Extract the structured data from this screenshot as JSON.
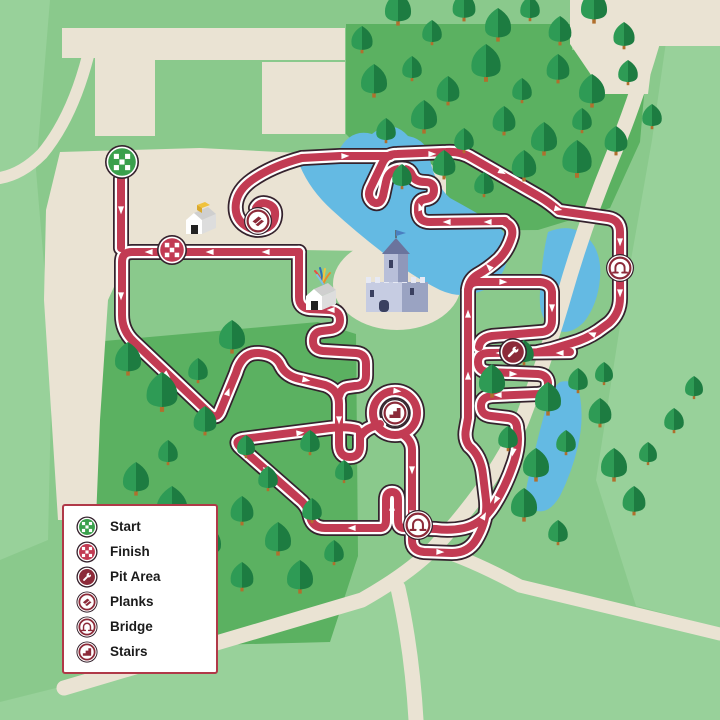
{
  "legend": {
    "items": [
      {
        "id": "start",
        "label": "Start"
      },
      {
        "id": "finish",
        "label": "Finish"
      },
      {
        "id": "pit",
        "label": "Pit Area"
      },
      {
        "id": "planks",
        "label": "Planks"
      },
      {
        "id": "bridge",
        "label": "Bridge"
      },
      {
        "id": "stairs",
        "label": "Stairs"
      }
    ]
  },
  "map": {
    "colors": {
      "base": "#8AC98C",
      "light": "#98D19A",
      "forest": "#5BB161",
      "beige": "#EAE3D3",
      "water": "#64BAE3",
      "red": "#C23B53",
      "dark": "#35222D",
      "maroon": "#8C2A39",
      "green": "#3AA04C",
      "treeL": "#2E9B55",
      "treeD": "#1D7C41",
      "trunk": "#B06F2D",
      "white": "#FFFFFF",
      "legendBorder": "#B03948"
    },
    "light_patches": [
      "M0,0 L50,0 L36,170 L52,360 L48,540 L0,560 Z",
      "M64,686 L360,602 L432,552 L520,586 L720,636 L720,720 L0,720 L0,702 Z",
      "M672,0 L720,0 L720,628 L636,606 L596,480 L624,300 L652,140 Z"
    ],
    "forest_fields": [
      "M346,24 L572,24 L572,50 L648,50 L640,142 L610,208 L538,230 L440,231 L346,134 Z",
      "M93,342 L318,322 L356,334 L358,556 L330,642 L96,648 Z"
    ],
    "plazas": [
      "M62,28 L345,28 L345,60 L155,60 L155,70 L95,70 L95,58 L62,58 Z",
      "M95,70 L155,70 L155,136 L95,136 Z",
      "M262,62 L345,62 L345,134 L262,134 Z",
      "M570,0 L720,0 L720,46 L654,46 L648,94 L604,94 L570,44 Z",
      "M60,152 L200,148 L340,155 L430,163 L446,178 L446,240 L436,252 L300,250 L255,246 L130,252 L108,300 L100,420 L96,520 L58,520 L44,300 L46,210 Z"
    ],
    "castle_plaza": {
      "cx": 397,
      "cy": 284,
      "rx": 64,
      "ry": 46
    },
    "water": [
      "M300,166 Q318,150 338,152 Q350,128 372,134 Q392,118 408,136 Q428,140 430,160 Q436,186 450,198 Q472,210 492,222 Q510,232 508,254 Q506,278 484,290 Q462,300 440,290 Q408,274 382,252 Q356,232 332,210 Q310,190 300,166 Z",
      "M548,232 Q572,222 588,238 Q602,252 600,278 Q598,304 584,322 Q568,338 552,328 Q538,318 540,292 Q542,256 548,232 Z",
      "M560,382 Q576,378 580,396 Q584,420 578,446 Q572,472 560,496 Q548,516 534,510 Q522,504 528,480 Q538,436 546,408 Q552,388 560,382 Z"
    ],
    "roads": [
      {
        "d": "M664,0 Q642,86 612,158 Q584,226 564,296 Q548,352 522,420 Q498,478 434,548 Q408,574 362,600 L64,688",
        "w": 15
      },
      {
        "d": "M434,548 Q472,560 520,586 L720,634",
        "w": 13
      },
      {
        "d": "M398,588 Q412,650 416,720",
        "w": 15
      },
      {
        "d": "M88,56 Q72,118 42,154 Q22,174 0,178",
        "w": 12
      }
    ],
    "course": {
      "subpaths": [
        "M121,179 L121,248",
        "M299,252 L132,252 Q122,252 122,262 L122,315 Q122,331 134,342 L209,413 Q216,420 220,412 L236,373 Q242,352 259,353 Q276,354 281,366 Q286,376 300,379 L325,385 Q339,390 339,404 L339,444 Q339,457 350,457 Q360,457 360,446 L360,432",
        "M299,252 L299,297 Q299,308 310,309 L330,310 Q340,311 340,320 Q340,329 330,330 L322,331 Q313,332 313,341 Q313,350 323,351 L356,353 Q366,354 366,364 L366,375 Q366,386 355,386 L348,387 Q341,388 339,396",
        "M360,437 Q364,430 372,427 L380,424",
        "M402,434 Q412,440 412,450 L412,540 Q412,551 424,552 L452,553 Q468,553 476,540 Q488,520 486,500 L483,475 Q481,456 469,446 Q464,439 466,429 L468,418 L468,292 Q468,282 478,282 L540,282 Q551,283 552,292 L552,320 Q552,331 542,332 L492,336 Q480,338 479,347",
        "M517,428 Q520,444 514,462 Q506,486 494,505 Q482,524 464,528 Q450,531 436,529 L404,528 Q398,528 398,520 L398,500 Q398,492 392,492 Q386,492 386,500 L386,520 Q386,528 380,528 L325,528 Q313,528 310,517 Q308,506 299,499 L241,448 Q233,441 243,439 L330,428 Q346,426 357,429",
        "M570,352 L489,353 Q478,353 478,362 Q478,371 488,372 L538,374 Q548,375 548,384 Q548,393 538,394 L492,396 Q481,397 481,406 Q481,415 491,416 L508,418 Q516,419 517,427",
        "M505,222 Q514,226 512,236 Q508,250 499,259 Q488,269 477,275 Q469,280 468,290",
        "M505,221 L430,222 Q419,222 418,212 L418,208 Q418,200 426,199 Q434,198 434,190 Q434,182 425,182 Q415,182 412,175 Q409,167 398,169 Q388,171 386,182 L383,196 Q380,206 373,202 Q367,197 370,189 L382,164 Q386,154 397,154 L446,152 Q461,151 472,158 L540,197 Q550,203 559,211 L608,218 Q620,220 620,232 L620,298 Q620,313 609,323 L598,331 Q586,339 572,343 L552,349 Q543,351 538,352",
        "M302,158 Q272,166 252,180 Q238,190 236,203 Q234,216 243,224 Q253,232 264,229 Q274,226 275,216 Q276,207 268,204 Q260,201 256,208",
        "M302,158 L340,156 L390,156"
      ],
      "loop_circle": {
        "cx": 395,
        "cy": 413,
        "r": 22
      }
    },
    "arrows": [
      [
        121,
        210,
        90
      ],
      [
        121,
        296,
        90
      ],
      [
        149,
        252,
        180
      ],
      [
        210,
        252,
        180
      ],
      [
        266,
        252,
        180
      ],
      [
        167,
        375,
        41
      ],
      [
        228,
        392,
        -70
      ],
      [
        306,
        380,
        11
      ],
      [
        331,
        310,
        180
      ],
      [
        339,
        420,
        90
      ],
      [
        397,
        391,
        6
      ],
      [
        412,
        470,
        90
      ],
      [
        412,
        514,
        90
      ],
      [
        440,
        552,
        2
      ],
      [
        484,
        516,
        -62
      ],
      [
        468,
        376,
        -90
      ],
      [
        468,
        314,
        -90
      ],
      [
        503,
        282,
        2
      ],
      [
        552,
        308,
        90
      ],
      [
        560,
        353,
        180
      ],
      [
        500,
        353,
        180
      ],
      [
        513,
        374,
        2
      ],
      [
        498,
        395,
        180
      ],
      [
        513,
        452,
        100
      ],
      [
        496,
        500,
        118
      ],
      [
        352,
        528,
        180
      ],
      [
        392,
        507,
        -90
      ],
      [
        310,
        512,
        205
      ],
      [
        266,
        470,
        222
      ],
      [
        300,
        433,
        -6
      ],
      [
        488,
        222,
        180
      ],
      [
        447,
        222,
        180
      ],
      [
        420,
        207,
        250
      ],
      [
        403,
        166,
        -35
      ],
      [
        432,
        154,
        0
      ],
      [
        345,
        156,
        -2
      ],
      [
        502,
        172,
        28
      ],
      [
        558,
        209,
        13
      ],
      [
        620,
        242,
        90
      ],
      [
        620,
        293,
        90
      ],
      [
        592,
        334,
        200
      ],
      [
        489,
        267,
        225
      ]
    ],
    "markers": [
      {
        "type": "start",
        "x": 122,
        "y": 162,
        "r": 17
      },
      {
        "type": "finish",
        "x": 172,
        "y": 250,
        "r": 15
      },
      {
        "type": "planks",
        "x": 258,
        "y": 221,
        "r": 14
      },
      {
        "type": "bridge",
        "x": 620,
        "y": 268,
        "r": 14
      },
      {
        "type": "pit",
        "x": 513,
        "y": 352,
        "r": 14
      },
      {
        "type": "stairs",
        "x": 395,
        "y": 413,
        "r": 14
      },
      {
        "type": "bridge",
        "x": 418,
        "y": 525,
        "r": 15
      }
    ],
    "buildings": [
      {
        "kind": "hut",
        "x": 203,
        "y": 222,
        "crate": true
      },
      {
        "kind": "hut",
        "x": 323,
        "y": 298,
        "streamers": true
      },
      {
        "kind": "castle",
        "x": 396,
        "y": 288
      }
    ],
    "trees": [
      [
        362,
        52,
        26
      ],
      [
        398,
        24,
        32
      ],
      [
        432,
        44,
        24
      ],
      [
        464,
        20,
        28
      ],
      [
        498,
        40,
        32
      ],
      [
        530,
        20,
        24
      ],
      [
        560,
        44,
        28
      ],
      [
        594,
        22,
        32
      ],
      [
        624,
        48,
        26
      ],
      [
        374,
        96,
        32
      ],
      [
        412,
        80,
        24
      ],
      [
        448,
        104,
        28
      ],
      [
        486,
        80,
        36
      ],
      [
        522,
        102,
        24
      ],
      [
        558,
        82,
        28
      ],
      [
        592,
        106,
        32
      ],
      [
        628,
        84,
        24
      ],
      [
        386,
        142,
        24
      ],
      [
        424,
        132,
        32
      ],
      [
        464,
        152,
        24
      ],
      [
        504,
        134,
        28
      ],
      [
        544,
        154,
        32
      ],
      [
        582,
        132,
        24
      ],
      [
        616,
        154,
        28
      ],
      [
        402,
        188,
        24
      ],
      [
        444,
        178,
        28
      ],
      [
        484,
        196,
        24
      ],
      [
        524,
        180,
        30
      ],
      [
        577,
        176,
        36
      ],
      [
        652,
        128,
        24
      ],
      [
        128,
        374,
        32
      ],
      [
        162,
        410,
        38
      ],
      [
        198,
        382,
        24
      ],
      [
        232,
        352,
        32
      ],
      [
        205,
        434,
        28
      ],
      [
        168,
        464,
        24
      ],
      [
        136,
        494,
        32
      ],
      [
        172,
        524,
        38
      ],
      [
        208,
        557,
        32
      ],
      [
        242,
        524,
        28
      ],
      [
        268,
        490,
        24
      ],
      [
        246,
        457,
        22
      ],
      [
        278,
        554,
        32
      ],
      [
        312,
        522,
        24
      ],
      [
        242,
        590,
        28
      ],
      [
        300,
        592,
        32
      ],
      [
        334,
        564,
        24
      ],
      [
        124,
        546,
        24
      ],
      [
        310,
        454,
        24
      ],
      [
        344,
        482,
        22
      ],
      [
        492,
        396,
        32
      ],
      [
        524,
        364,
        24
      ],
      [
        548,
        414,
        32
      ],
      [
        578,
        392,
        24
      ],
      [
        508,
        450,
        24
      ],
      [
        536,
        480,
        32
      ],
      [
        566,
        454,
        24
      ],
      [
        600,
        426,
        28
      ],
      [
        614,
        480,
        32
      ],
      [
        634,
        514,
        28
      ],
      [
        524,
        520,
        32
      ],
      [
        558,
        544,
        24
      ],
      [
        648,
        464,
        22
      ],
      [
        674,
        432,
        24
      ],
      [
        694,
        398,
        22
      ],
      [
        604,
        384,
        22
      ]
    ]
  }
}
